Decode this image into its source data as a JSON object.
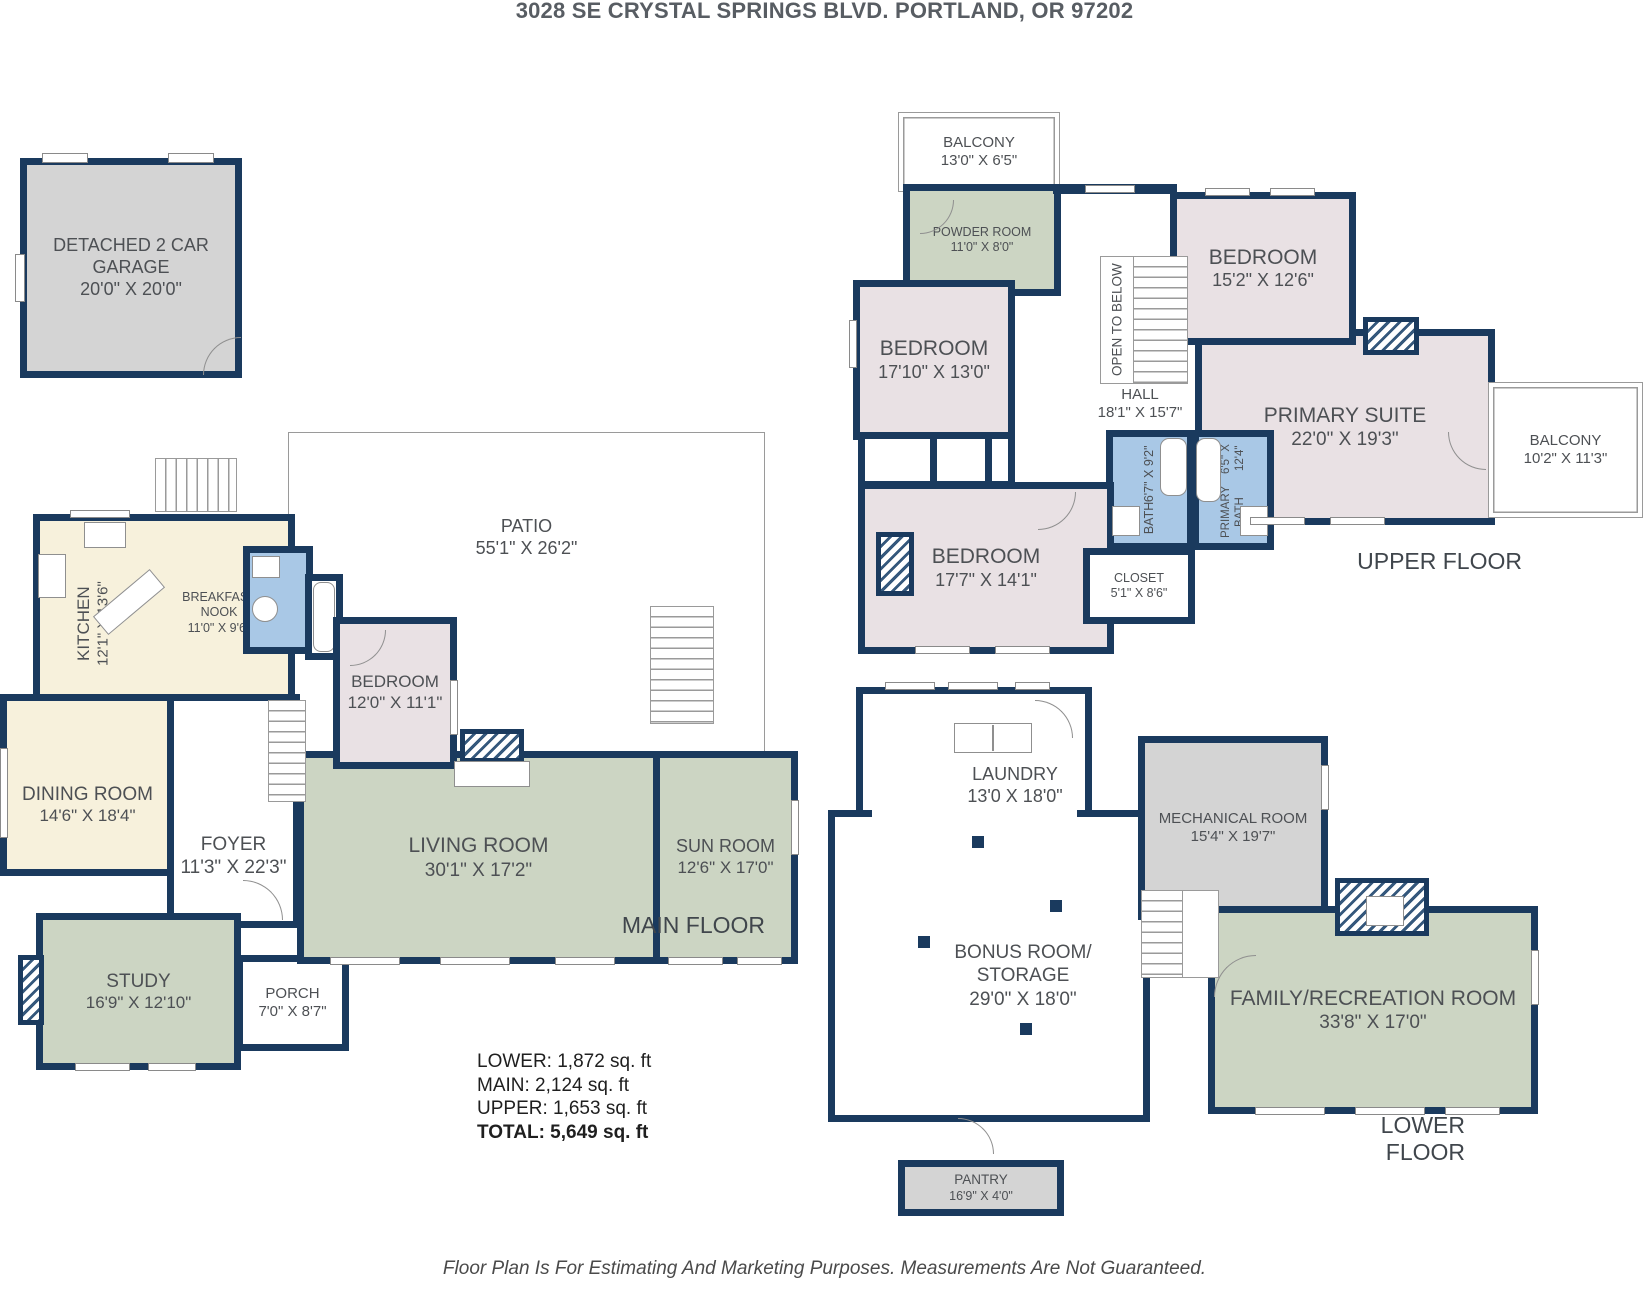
{
  "title": "3028 SE CRYSTAL SPRINGS BLVD. PORTLAND, OR 97202",
  "disclaimer": "Floor Plan Is For Estimating And Marketing Purposes. Measurements Are Not Guaranteed.",
  "floor_labels": {
    "upper": "UPPER FLOOR",
    "main": "MAIN FLOOR",
    "lower": "LOWER FLOOR"
  },
  "area_summary": {
    "lower": "LOWER: 1,872 sq. ft",
    "main": "MAIN: 2,124 sq. ft",
    "upper": "UPPER: 1,653 sq. ft",
    "total": "TOTAL: 5,649 sq. ft"
  },
  "colors": {
    "wall": "#1a3a5e",
    "bedroom_fill": "#e9e1e4",
    "living_fill": "#ccd5c3",
    "kitchen_fill": "#f7f1dc",
    "bath_fill": "#a9c8e6",
    "garage_fill": "#d4d4d4"
  },
  "rooms": {
    "garage": {
      "name": "DETACHED 2 CAR GARAGE",
      "dims": "20'0\" X 20'0\""
    },
    "balcony_top": {
      "name": "BALCONY",
      "dims": "13'0\" X 6'5\""
    },
    "powder_room": {
      "name": "POWDER ROOM",
      "dims": "11'0\" X 8'0\""
    },
    "bedroom_upper_1": {
      "name": "BEDROOM",
      "dims": "17'10\" X 13'0\""
    },
    "bedroom_upper_2": {
      "name": "BEDROOM",
      "dims": "15'2\" X 12'6\""
    },
    "open_to_below": {
      "name": "OPEN TO BELOW"
    },
    "hall": {
      "name": "HALL",
      "dims": "18'1\" X 15'7\""
    },
    "primary_suite": {
      "name": "PRIMARY SUITE",
      "dims": "22'0\" X 19'3\""
    },
    "balcony_right": {
      "name": "BALCONY",
      "dims": "10'2\" X 11'3\""
    },
    "bath_upper": {
      "name": "BATH",
      "dims": "6'7\" X 9'2\""
    },
    "primary_bath": {
      "name": "PRIMARY BATH",
      "dims": "6'5\" X 12'4\""
    },
    "bedroom_upper_3": {
      "name": "BEDROOM",
      "dims": "17'7\" X 14'1\""
    },
    "closet_upper": {
      "name": "CLOSET",
      "dims": "5'1\" X 8'6\""
    },
    "patio": {
      "name": "PATIO",
      "dims": "55'1\" X 26'2\""
    },
    "kitchen": {
      "name": "KITCHEN",
      "dims": "12'1\" X 13'6\""
    },
    "breakfast_nook": {
      "name": "BREAKFAST NOOK",
      "dims": "11'0\" X 9'6\""
    },
    "bedroom_main": {
      "name": "BEDROOM",
      "dims": "12'0\" X 11'1\""
    },
    "dining_room": {
      "name": "DINING ROOM",
      "dims": "14'6\" X 18'4\""
    },
    "foyer": {
      "name": "FOYER",
      "dims": "11'3\" X 22'3\""
    },
    "living_room": {
      "name": "LIVING ROOM",
      "dims": "30'1\" X 17'2\""
    },
    "sun_room": {
      "name": "SUN ROOM",
      "dims": "12'6\" X 17'0\""
    },
    "study": {
      "name": "STUDY",
      "dims": "16'9\" X 12'10\""
    },
    "porch": {
      "name": "PORCH",
      "dims": "7'0\" X 8'7\""
    },
    "laundry": {
      "name": "LAUNDRY",
      "dims": "13'0 X 18'0\""
    },
    "mechanical_room": {
      "name": "MECHANICAL ROOM",
      "dims": "15'4\" X 19'7\""
    },
    "bonus_room": {
      "name": "BONUS ROOM/ STORAGE",
      "dims": "29'0\" X 18'0\""
    },
    "family_room": {
      "name": "FAMILY/RECREATION ROOM",
      "dims": "33'8\" X 17'0\""
    },
    "pantry": {
      "name": "PANTRY",
      "dims": "16'9\" X 4'0\""
    }
  }
}
